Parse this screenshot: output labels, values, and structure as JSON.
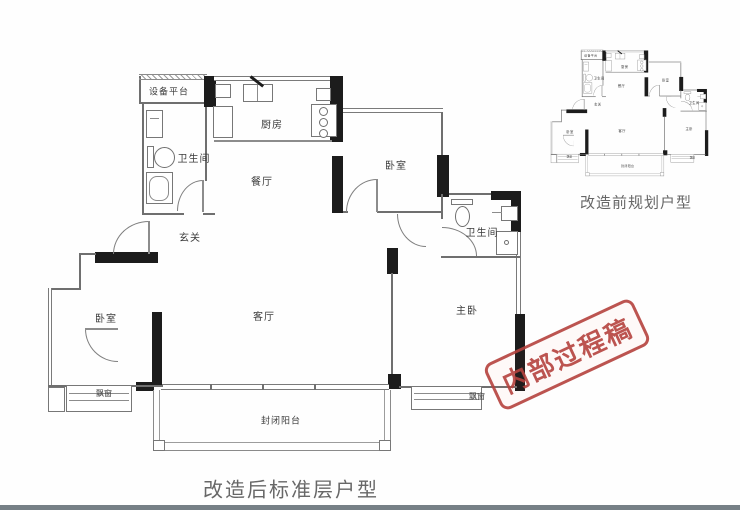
{
  "captions": {
    "main": "改造后标准层户型",
    "mini": "改造前规划户型"
  },
  "stamp": {
    "text": "内部过程稿",
    "color": "#b5423e"
  },
  "rooms": {
    "equipment_platform": "设备平台",
    "bathroom_left": "卫生间",
    "kitchen": "厨房",
    "dining": "餐厅",
    "entry": "玄关",
    "bedroom_top": "卧室",
    "bathroom_right": "卫生间",
    "bedroom_left": "卧室",
    "living": "客厅",
    "master": "主卧",
    "bay_left": "飘窗",
    "bay_right": "飘窗",
    "balcony": "封闭阳台"
  },
  "colors": {
    "wall": "#6f6f6f",
    "structural_wall": "#1c1c1c",
    "stamp_red": "#b5423e",
    "caption_gray": "#676767",
    "bottom_edge": "#768086"
  }
}
